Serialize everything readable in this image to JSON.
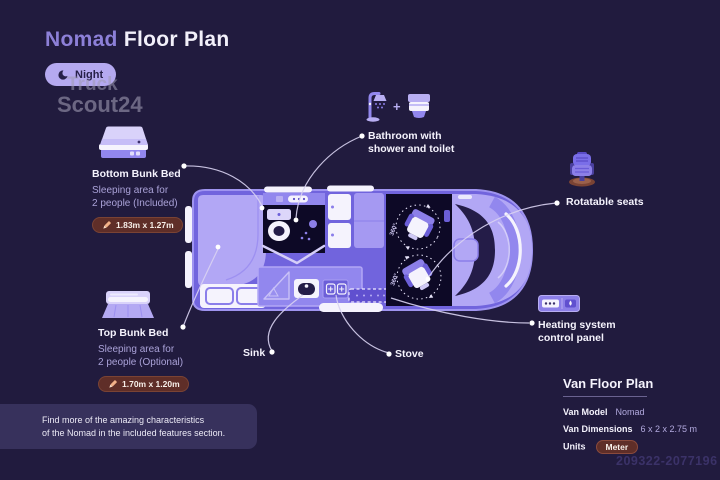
{
  "page": {
    "title_accent": "Nomad",
    "title_rest": "Floor Plan"
  },
  "night_toggle": {
    "label": "Night",
    "icon": "moon-icon"
  },
  "watermark": {
    "brand_top": "Truck",
    "brand_bottom": "Scout24",
    "listing_id": "209322-2077196"
  },
  "callouts": {
    "bottom_bunk": {
      "title": "Bottom Bunk Bed",
      "desc1": "Sleeping area for",
      "desc2": "2 people (Included)",
      "dimensions": "1.83m x 1.27m"
    },
    "top_bunk": {
      "title": "Top Bunk Bed",
      "desc1": "Sleeping area for",
      "desc2": "2 people (Optional)",
      "dimensions": "1.70m x 1.20m"
    },
    "bathroom": {
      "plus": "+",
      "line1": "Bathroom with",
      "line2": "shower and toilet"
    },
    "rotatable_seats": {
      "label": "Rotatable seats"
    },
    "heating": {
      "line1": "Heating system",
      "line2": "control panel"
    },
    "sink": {
      "label": "Sink"
    },
    "stove": {
      "label": "Stove"
    }
  },
  "floor_plan": {
    "rotation_label": "360°"
  },
  "footer_note": {
    "line1": "Find more of the amazing characteristics",
    "line2": "of the Nomad in the included features section."
  },
  "spec_panel": {
    "title": "Van Floor Plan",
    "rows": [
      {
        "label": "Van Model",
        "value": "Nomad"
      },
      {
        "label": "Van Dimensions",
        "value": "6 x 2 x 2.75 m"
      }
    ],
    "units": {
      "label": "Units",
      "value": "Meter"
    }
  },
  "colors": {
    "background": "#211b3e",
    "accent_purple": "#8d80d8",
    "van_body": "#7164dd",
    "van_light": "#b2a7f5",
    "dark_room": "#0d0926",
    "badge_maroon": "#5f2e28",
    "night_pill": "#b5a9f0",
    "white": "#f5f3fd"
  }
}
